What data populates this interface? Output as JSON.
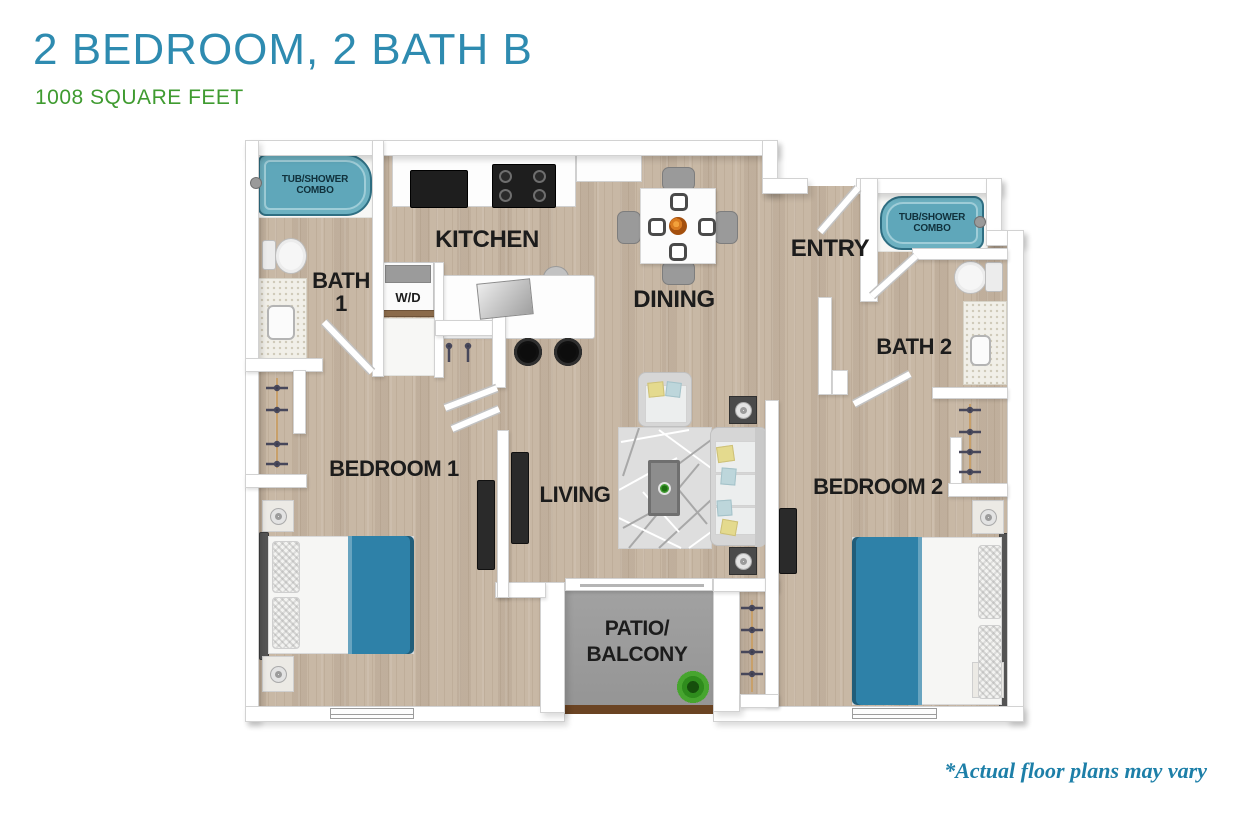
{
  "header": {
    "title": "2 BEDROOM, 2 BATH B",
    "subtitle": "1008 SQUARE FEET"
  },
  "footer": {
    "disclaimer": "*Actual floor plans may vary"
  },
  "colors": {
    "title": "#2e8bb0",
    "subtitle": "#3f9b30",
    "disclaimer": "#1d7fa8",
    "label": "#1c1c1c",
    "wood": "#c8b8a5",
    "patio": "#9d9d9d",
    "tub": "#6db1c1",
    "bed_blanket": "#2e81a8",
    "wall": "#ffffff"
  },
  "rooms": {
    "kitchen": {
      "label": "KITCHEN"
    },
    "dining": {
      "label": "DINING"
    },
    "entry": {
      "label": "ENTRY"
    },
    "living": {
      "label": "LIVING"
    },
    "bath1": {
      "line1": "BATH",
      "line2": "1"
    },
    "bath2": {
      "label": "BATH 2"
    },
    "bedroom1": {
      "label": "BEDROOM 1"
    },
    "bedroom2": {
      "label": "BEDROOM 2"
    },
    "patio": {
      "line1": "PATIO/",
      "line2": "BALCONY"
    },
    "laundry": {
      "label": "W/D"
    },
    "tub_shower_1": {
      "line1": "TUB/SHOWER",
      "line2": "COMBO"
    },
    "tub_shower_2": {
      "line1": "TUB/SHOWER",
      "line2": "COMBO"
    }
  }
}
